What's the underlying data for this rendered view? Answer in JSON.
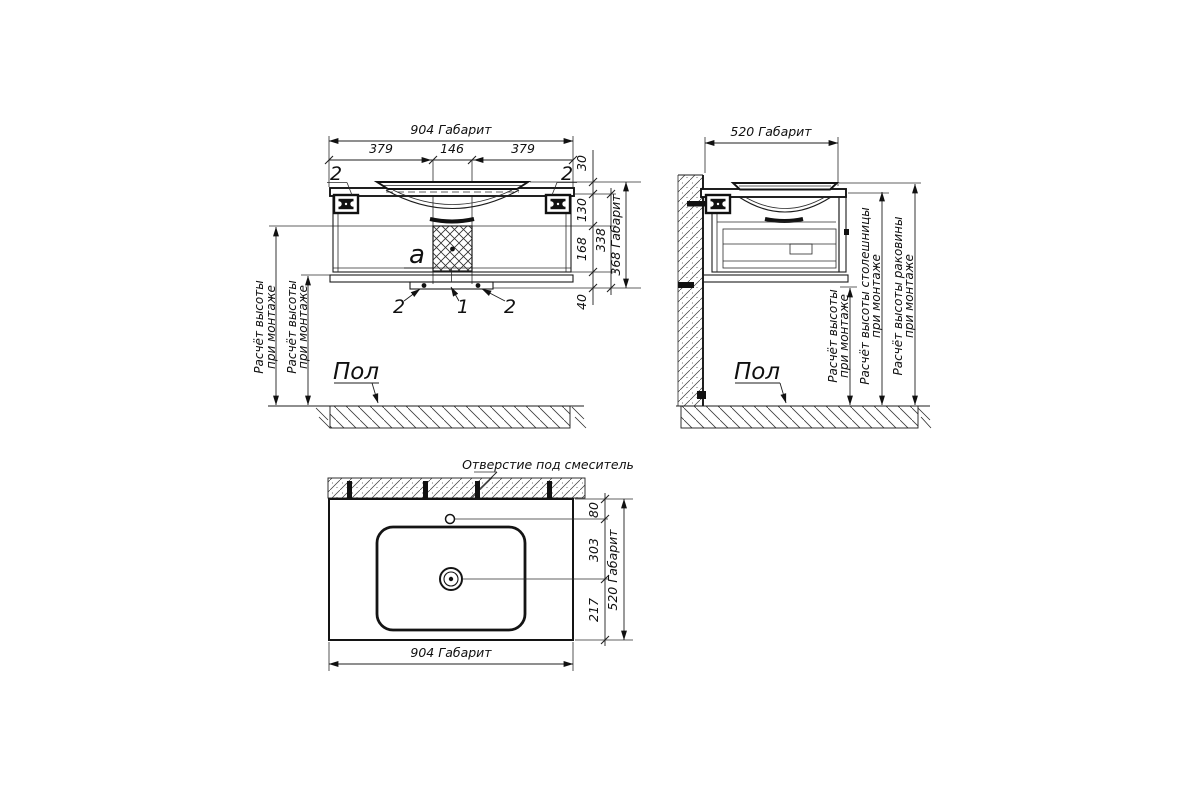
{
  "front_view": {
    "dim_overall_width": "904 Габарит",
    "dim_left_segment": "379",
    "dim_center_segment": "146",
    "dim_right_segment": "379",
    "dim_rim_offset": "30",
    "dim_upper_section": "130",
    "dim_lower_section": "168",
    "dim_body_height": "338",
    "dim_overall_height": "368 Габарит",
    "dim_plinth_height": "40",
    "callout_top_left": "2",
    "callout_top_right": "2",
    "callout_block": "a",
    "callout_bottom_left": "2",
    "callout_bottom_center": "1",
    "callout_bottom_right": "2",
    "mount_height_1_line1": "Расчёт высоты",
    "mount_height_1_line2": "при монтаже",
    "mount_height_2_line1": "Расчёт высоты",
    "mount_height_2_line2": "при монтаже",
    "floor_label": "Пол"
  },
  "side_view": {
    "dim_overall_depth": "520 Габарит",
    "mount_height_line1": "Расчёт высоты",
    "mount_height_line2": "при монтаже",
    "countertop_height_line1": "Расчёт высоты столешницы",
    "countertop_height_line2": "при монтаже",
    "sink_height_line1": "Расчёт высоты раковины",
    "sink_height_line2": "при монтаже",
    "floor_label": "Пол"
  },
  "plan_view": {
    "faucet_hole_label": "Отверстие под смеситель",
    "dim_faucet_offset": "80",
    "dim_faucet_to_drain": "303",
    "dim_drain_to_front": "217",
    "dim_overall_depth": "520 Габарит",
    "dim_overall_width": "904 Габарит"
  }
}
